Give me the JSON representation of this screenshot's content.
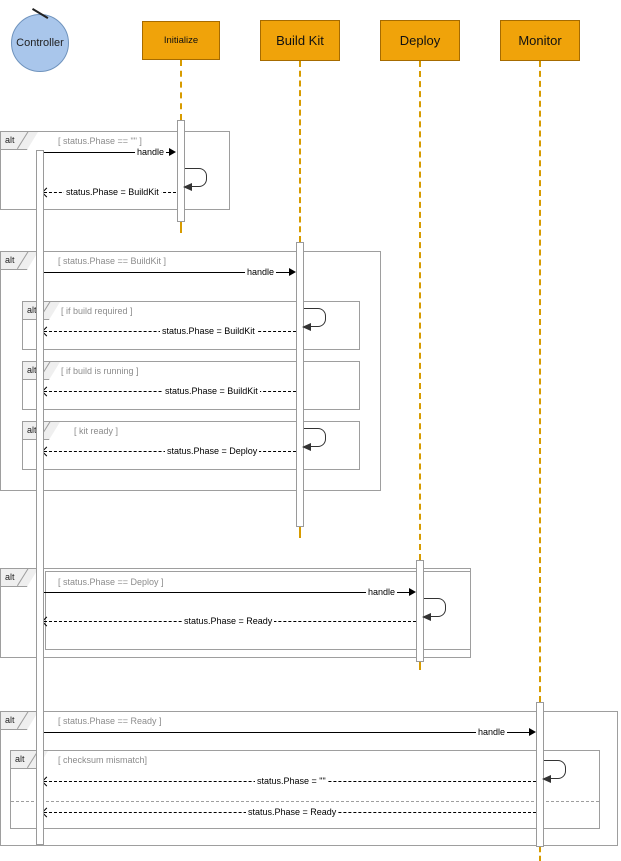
{
  "actor": {
    "label": "Controller"
  },
  "lifelines": [
    {
      "label": "Initialize"
    },
    {
      "label": "Build Kit"
    },
    {
      "label": "Deploy"
    },
    {
      "label": "Monitor"
    }
  ],
  "fragments": {
    "phase_empty": {
      "operator": "alt",
      "condition": "[ status.Phase == \"\" ]"
    },
    "phase_buildkit": {
      "operator": "alt",
      "condition": "[ status.Phase == BuildKit ]"
    },
    "build_required": {
      "operator": "alt",
      "condition": "[ if build required ]"
    },
    "build_running": {
      "operator": "alt",
      "condition": "[ if build is running ]"
    },
    "kit_ready": {
      "operator": "alt",
      "condition": "[ kit ready ]"
    },
    "phase_deploy": {
      "operator": "alt",
      "condition": "[ status.Phase == Deploy ]"
    },
    "phase_ready": {
      "operator": "alt",
      "condition": "[ status.Phase == Ready ]"
    },
    "checksum_mismatch": {
      "operator": "alt",
      "condition": "[ checksum mismatch]"
    }
  },
  "messages": {
    "handle": "handle",
    "set_buildkit": "status.Phase = BuildKit",
    "set_deploy": "status.Phase = Deploy",
    "set_ready": "status.Phase = Ready",
    "set_empty": "status.Phase = \"\""
  },
  "colors": {
    "lifeline_head_fill": "#f0a30a",
    "lifeline_head_stroke": "#a66b00",
    "actor_fill": "#a9c6eb",
    "actor_stroke": "#6f93bd",
    "lifeline_dash": "#d79b00",
    "frame_stroke": "#9e9e9e",
    "condition_text": "#8c8c8c",
    "message_text": "#000000"
  }
}
